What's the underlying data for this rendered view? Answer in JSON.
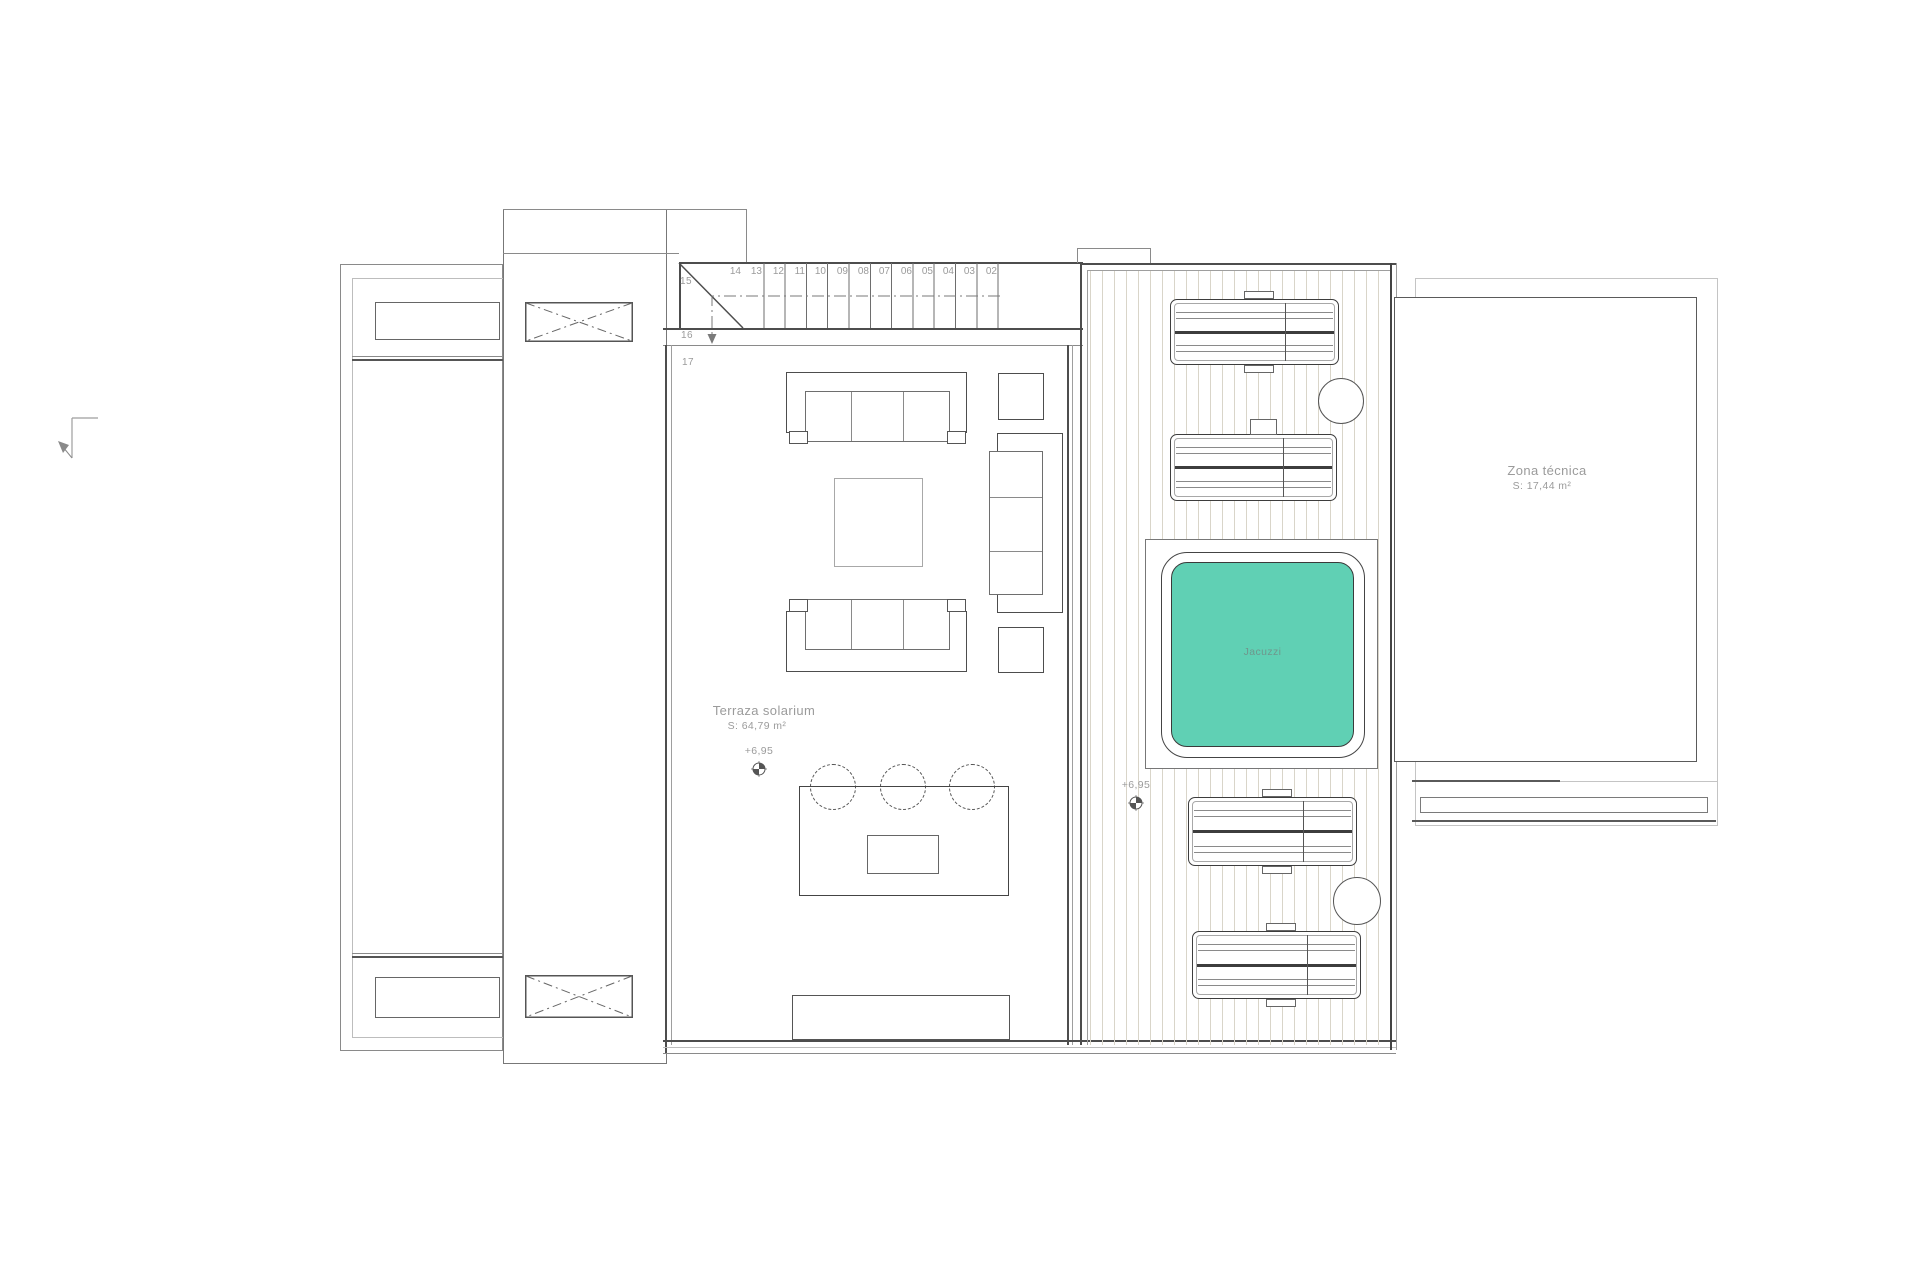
{
  "plan": {
    "terrace": {
      "name": "Terraza solarium",
      "area": "S: 64,79 m²",
      "level": "+6,95"
    },
    "deck": {
      "level": "+6,95",
      "jacuzzi_label": "Jacuzzi"
    },
    "tech_zone": {
      "name": "Zona técnica",
      "area": "S: 17,44 m²"
    },
    "stairs": {
      "treads": [
        "14",
        "13",
        "12",
        "11",
        "10",
        "09",
        "08",
        "07",
        "06",
        "05",
        "04",
        "03",
        "02"
      ],
      "winder_label": "15",
      "landing_label": "16",
      "lower_label": "17"
    },
    "colors": {
      "jacuzzi_fill": "#60d0b4",
      "deck_plank_line": "#d9d5c9",
      "wall_dark": "#4d4d4d",
      "label_gray": "#9b9b9b"
    }
  }
}
